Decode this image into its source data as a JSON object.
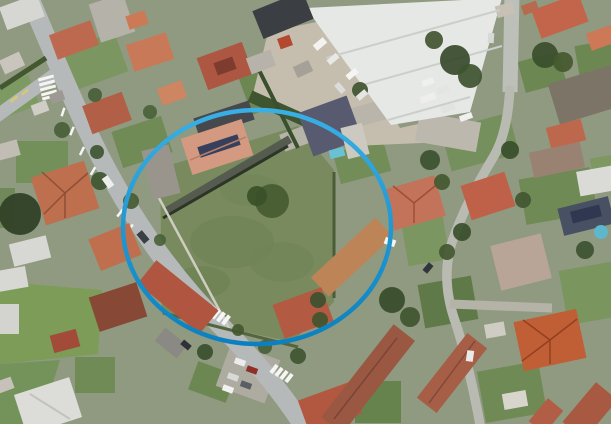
{
  "canvas": {
    "w": 611,
    "h": 424,
    "base": "#8f9a80"
  },
  "annotation": {
    "shape": "ellipse",
    "cx": 257,
    "cy": 227,
    "rx": 134,
    "ry": 117,
    "stroke_w": 4.5,
    "grad_top": "#39b0e5",
    "grad_bottom": "#0b80c0"
  },
  "gardens": [
    [
      272,
      82,
      60,
      48,
      -20,
      "#6d8753"
    ],
    [
      480,
      142,
      70,
      42,
      -15,
      "#75905c"
    ],
    [
      558,
      196,
      72,
      46,
      -10,
      "#6f8a55"
    ],
    [
      598,
      292,
      70,
      55,
      -10,
      "#7a955e"
    ],
    [
      512,
      392,
      62,
      52,
      -10,
      "#6f8a55"
    ],
    [
      378,
      402,
      46,
      42,
      0,
      "#66824d"
    ],
    [
      92,
      62,
      62,
      42,
      -20,
      "#7b9660"
    ],
    [
      14,
      97,
      42,
      32,
      -20,
      "#7e9a63"
    ],
    [
      142,
      142,
      52,
      38,
      -18,
      "#708b56"
    ],
    [
      600,
      62,
      45,
      40,
      -10,
      "#6d8753"
    ],
    [
      448,
      302,
      54,
      44,
      -10,
      "#5f7a48"
    ],
    [
      42,
      162,
      52,
      42,
      0,
      "#74905a"
    ],
    [
      8,
      392,
      32,
      32,
      0,
      "#75905c"
    ],
    [
      542,
      72,
      42,
      32,
      -15,
      "#6d8753"
    ],
    [
      362,
      162,
      52,
      32,
      -15,
      "#728d58"
    ],
    [
      424,
      232,
      42,
      62,
      -10,
      "#7b9660"
    ],
    [
      612,
      170,
      40,
      30,
      -10,
      "#7d9861"
    ],
    [
      212,
      382,
      40,
      30,
      20,
      "#6d8753"
    ],
    [
      95,
      375,
      40,
      36,
      0,
      "#708b56"
    ],
    [
      0,
      208,
      30,
      40,
      0,
      "#70895a"
    ]
  ],
  "fields": [
    {
      "pts": [
        [
          0,
          282
        ],
        [
          102,
          290
        ],
        [
          98,
          354
        ],
        [
          0,
          364
        ]
      ],
      "fill": "#7c9c58"
    },
    {
      "pts": [
        [
          0,
          364
        ],
        [
          60,
          360
        ],
        [
          40,
          424
        ],
        [
          0,
          424
        ]
      ],
      "fill": "#74935a"
    }
  ],
  "lawn": {
    "pts": [
      [
        160,
        168
      ],
      [
        298,
        126
      ],
      [
        334,
        170
      ],
      [
        334,
        302
      ],
      [
        292,
        342
      ],
      [
        162,
        314
      ]
    ],
    "fill": "#798b5e"
  },
  "lawn_spots": [
    [
      232,
      242,
      42,
      26,
      "#6e8253"
    ],
    [
      282,
      262,
      32,
      20,
      "#708457"
    ],
    [
      202,
      282,
      28,
      16,
      "#6c8051"
    ],
    [
      250,
      190,
      30,
      16,
      "#70855a"
    ]
  ],
  "yard": {
    "pts": [
      [
        268,
        32
      ],
      [
        336,
        18
      ],
      [
        400,
        128
      ],
      [
        436,
        120
      ],
      [
        444,
        142
      ],
      [
        352,
        146
      ],
      [
        252,
        98
      ]
    ],
    "fill": "#c5beae"
  },
  "warehouse": {
    "pts": [
      [
        306,
        8
      ],
      [
        502,
        -2
      ],
      [
        470,
        112
      ],
      [
        391,
        125
      ]
    ],
    "fill": "#e6e8e5"
  },
  "paved": [
    [
      448,
      132,
      62,
      30,
      10,
      "#bcb8ad"
    ],
    [
      302,
      136,
      42,
      18,
      -20,
      "#b6b3a8"
    ],
    [
      360,
      116,
      52,
      20,
      -15,
      "#b9b5aa"
    ],
    [
      248,
      373,
      52,
      46,
      20,
      "#aeaba1"
    ],
    [
      112,
      18,
      36,
      40,
      -18,
      "#b5b2a9"
    ]
  ],
  "roads": [
    {
      "d": "M 28,-6 C 60,70 85,130 110,175 C 140,230 175,280 225,330 C 255,360 285,396 306,430",
      "w": 19,
      "c": "#b6b9ba",
      "n": "main-road"
    },
    {
      "d": "M -6,118 L 58,72",
      "w": 13,
      "c": "#b6b9ba",
      "n": "side-street"
    },
    {
      "d": "M 512,-6 L 510,92",
      "w": 15,
      "c": "#bdbfb9",
      "n": "right-street"
    },
    {
      "d": "M 510,86 Q 508,132 494,156 Q 466,202 452,242 Q 440,280 456,324 Q 469,364 481,430",
      "w": 9.5,
      "c": "#b9bbb3",
      "n": "right-lane"
    },
    {
      "d": "M 450,304 L 552,308",
      "w": 9,
      "c": "#b5b2a8",
      "n": "driveway-lane"
    }
  ],
  "ground_lines": [
    [
      250,
      96,
      362,
      146,
      "#3f5530",
      12
    ],
    [
      165,
      212,
      290,
      139,
      "#565b50",
      8
    ],
    [
      163,
      218,
      288,
      146,
      "#2c3526",
      3
    ],
    [
      152,
      185,
      230,
      330,
      "#cfcdc2",
      2.5
    ],
    [
      163,
      313,
      298,
      347,
      "#55663f",
      3
    ],
    [
      334,
      172,
      334,
      298,
      "#4a5c38",
      3
    ],
    [
      0,
      88,
      46,
      58,
      "#44582f",
      5
    ],
    [
      255,
      62,
      298,
      148,
      "#3a4f2c",
      4
    ]
  ],
  "markings": [
    [
      46,
      78,
      16,
      3,
      -15,
      "#f5f5f3"
    ],
    [
      47,
      83,
      16,
      3,
      -15,
      "#f5f5f3"
    ],
    [
      48,
      88,
      16,
      3,
      -15,
      "#f5f5f3"
    ],
    [
      49,
      93,
      16,
      3,
      -15,
      "#f5f5f3"
    ],
    [
      50,
      97,
      16,
      3,
      -15,
      "#f5f5f3"
    ],
    [
      14,
      99,
      9,
      2.5,
      -38,
      "#d8c96d"
    ],
    [
      25,
      92,
      8,
      2.5,
      -38,
      "#d8c96d"
    ],
    [
      63,
      112,
      2.5,
      9,
      18,
      "#f5f5f3"
    ],
    [
      72,
      131,
      2.5,
      9,
      22,
      "#f5f5f3"
    ],
    [
      82,
      151,
      2.5,
      9,
      26,
      "#f5f5f3"
    ],
    [
      93,
      171,
      2.5,
      9,
      30,
      "#f5f5f3"
    ],
    [
      120,
      213,
      2.5,
      9,
      38,
      "#f5f5f3"
    ],
    [
      130,
      228,
      2.5,
      9,
      40,
      "#f5f5f3"
    ],
    [
      206,
      308,
      4,
      11,
      38,
      "#f5f5f3"
    ],
    [
      211,
      311,
      4,
      11,
      38,
      "#f5f5f3"
    ],
    [
      216,
      314,
      4,
      11,
      38,
      "#f5f5f3"
    ],
    [
      221,
      317,
      4,
      11,
      38,
      "#f5f5f3"
    ],
    [
      226,
      320,
      4,
      11,
      38,
      "#f5f5f3"
    ],
    [
      274,
      369,
      4,
      10,
      38,
      "#f5f5f3"
    ],
    [
      279,
      372,
      4,
      10,
      38,
      "#f5f5f3"
    ],
    [
      284,
      375,
      4,
      10,
      38,
      "#f5f5f3"
    ],
    [
      289,
      378,
      4,
      10,
      38,
      "#f5f5f3"
    ]
  ],
  "buildings": [
    [
      22,
      12,
      40,
      24,
      -20,
      "#d6d6d2"
    ],
    [
      74,
      40,
      44,
      26,
      -20,
      "#bd6950"
    ],
    [
      150,
      52,
      42,
      28,
      -18,
      "#c87a58"
    ],
    [
      107,
      113,
      42,
      30,
      -20,
      "#b25f47"
    ],
    [
      172,
      93,
      26,
      18,
      -20,
      "#cd8562"
    ],
    [
      12,
      63,
      22,
      15,
      -25,
      "#c9c5bc"
    ],
    [
      57,
      97,
      14,
      10,
      -20,
      "#9c9a92"
    ],
    [
      137,
      20,
      20,
      14,
      -18,
      "#cc7a55"
    ],
    [
      8,
      150,
      22,
      16,
      -15,
      "#c2bdb4"
    ],
    [
      40,
      108,
      16,
      11,
      -20,
      "#d0cdc6"
    ],
    [
      283,
      15,
      54,
      30,
      -22,
      "#3b3f44"
    ],
    [
      225,
      66,
      48,
      34,
      -20,
      "#ad5742"
    ],
    [
      285,
      42,
      13,
      11,
      -20,
      "#b34930"
    ],
    [
      261,
      62,
      26,
      17,
      -20,
      "#b7b3aa"
    ],
    [
      303,
      69,
      17,
      12,
      -25,
      "#a5a199"
    ],
    [
      560,
      16,
      50,
      30,
      -20,
      "#c2654a"
    ],
    [
      601,
      38,
      26,
      18,
      -20,
      "#cd7856"
    ],
    [
      585,
      95,
      65,
      42,
      -17,
      "#7b7467"
    ],
    [
      505,
      10,
      18,
      12,
      -15,
      "#c6c0b5"
    ],
    [
      530,
      8,
      16,
      10,
      -20,
      "#b86a4e"
    ],
    [
      566,
      134,
      36,
      22,
      -15,
      "#bd684c"
    ],
    [
      557,
      160,
      52,
      26,
      -12,
      "#9a8273"
    ],
    [
      596,
      181,
      36,
      25,
      -10,
      "#dadad6"
    ],
    [
      586,
      216,
      52,
      28,
      -14,
      "#485064"
    ],
    [
      488,
      196,
      46,
      36,
      -18,
      "#bf6048"
    ],
    [
      414,
      203,
      54,
      42,
      -16,
      "#c3735a"
    ],
    [
      521,
      262,
      52,
      46,
      -14,
      "#b8a598"
    ],
    [
      224,
      119,
      58,
      20,
      -18,
      "#45494e"
    ],
    [
      217,
      147,
      64,
      38,
      -18,
      "#d39a81"
    ],
    [
      161,
      172,
      28,
      50,
      -14,
      "#99958c"
    ],
    [
      330,
      126,
      52,
      46,
      -20,
      "#585a70"
    ],
    [
      352,
      257,
      88,
      26,
      -43,
      "#bd8457"
    ],
    [
      303,
      313,
      52,
      36,
      -20,
      "#b25a42"
    ],
    [
      115,
      247,
      44,
      34,
      -22,
      "#c06f4e"
    ],
    [
      178,
      297,
      80,
      30,
      39,
      "#b05640"
    ],
    [
      118,
      307,
      50,
      36,
      -18,
      "#884836"
    ],
    [
      171,
      343,
      28,
      17,
      39,
      "#8a8984"
    ],
    [
      65,
      193,
      56,
      50,
      -18,
      "#bd6f4e"
    ],
    [
      30,
      251,
      38,
      23,
      -14,
      "#d7d7d3"
    ],
    [
      12,
      279,
      30,
      21,
      -10,
      "#d7d7d3"
    ],
    [
      65,
      341,
      27,
      18,
      -15,
      "#a34b39"
    ],
    [
      8,
      319,
      22,
      30,
      0,
      "#d3d3cf"
    ],
    [
      48,
      406,
      58,
      42,
      -18,
      "#dcdcd8"
    ],
    [
      5,
      385,
      16,
      12,
      -20,
      "#c7c2b9"
    ],
    [
      330,
      407,
      56,
      34,
      -20,
      "#b25841"
    ],
    [
      368,
      379,
      118,
      27,
      -52,
      "#9a5843"
    ],
    [
      452,
      373,
      82,
      25,
      -52,
      "#a65e46"
    ],
    [
      550,
      340,
      64,
      50,
      -12,
      "#c05e36"
    ],
    [
      590,
      411,
      52,
      28,
      -50,
      "#a85942"
    ],
    [
      546,
      416,
      30,
      20,
      -50,
      "#b25e47"
    ],
    [
      515,
      400,
      24,
      16,
      -10,
      "#d8d5cd"
    ],
    [
      495,
      330,
      20,
      14,
      -10,
      "#cfccc3"
    ]
  ],
  "details_rects": [
    [
      225,
      66,
      20,
      13,
      -20,
      "#7e3c2e"
    ],
    [
      219,
      146,
      42,
      11,
      -18,
      "#36405c"
    ],
    [
      337,
      153,
      15,
      9,
      -14,
      "#68c2d4"
    ],
    [
      586,
      214,
      30,
      12,
      -14,
      "#2f3850"
    ],
    [
      355,
      141,
      22,
      32,
      -14,
      "#ccc9c0"
    ]
  ],
  "details_lines": [
    [
      326,
      58,
      500,
      10,
      "#cbcfcc",
      2
    ],
    [
      352,
      88,
      502,
      46,
      "#cbcfcc",
      2
    ],
    [
      388,
      120,
      470,
      97,
      "#cbcfcc",
      2
    ],
    [
      42,
      172,
      65,
      193,
      "#8f4f35",
      1.5
    ],
    [
      88,
      173,
      65,
      193,
      "#8f4f35",
      1.5
    ],
    [
      65,
      218,
      65,
      193,
      "#8f4f35",
      1.5
    ],
    [
      44,
      214,
      65,
      193,
      "#8f4f35",
      1.5
    ],
    [
      523,
      320,
      550,
      340,
      "#93401f",
      1.5
    ],
    [
      577,
      319,
      550,
      340,
      "#93401f",
      1.5
    ],
    [
      550,
      364,
      550,
      340,
      "#93401f",
      1.5
    ],
    [
      522,
      361,
      550,
      340,
      "#93401f",
      1.5
    ],
    [
      393,
      186,
      414,
      203,
      "#9c4f3a",
      1.5
    ],
    [
      435,
      186,
      414,
      203,
      "#9c4f3a",
      1.5
    ],
    [
      414,
      223,
      414,
      203,
      "#9c4f3a",
      1.5
    ],
    [
      190,
      160,
      246,
      137,
      "#b98069",
      1.5
    ],
    [
      30,
      394,
      70,
      419,
      "#c2c2be",
      2
    ],
    [
      334,
      419,
      397,
      338,
      "#7a4435",
      1.5
    ],
    [
      429,
      403,
      475,
      341,
      "#84493a",
      1.5
    ]
  ],
  "circles": [
    [
      601,
      232,
      7,
      "#5fb7cc"
    ]
  ],
  "trees": [
    [
      455,
      60,
      15,
      "#37492b"
    ],
    [
      470,
      76,
      12,
      "#3e5230"
    ],
    [
      434,
      40,
      9,
      "#415430"
    ],
    [
      545,
      55,
      13,
      "#3a4e2d"
    ],
    [
      563,
      62,
      10,
      "#44582f"
    ],
    [
      20,
      214,
      21,
      "#2f3f26"
    ],
    [
      100,
      181,
      9,
      "#3f5530"
    ],
    [
      131,
      201,
      8,
      "#475c33"
    ],
    [
      62,
      130,
      8,
      "#48603a"
    ],
    [
      97,
      152,
      7,
      "#3f5530"
    ],
    [
      150,
      112,
      7,
      "#4a6238"
    ],
    [
      430,
      160,
      10,
      "#3c5130"
    ],
    [
      442,
      182,
      8,
      "#44582f"
    ],
    [
      462,
      232,
      9,
      "#3a4e2c"
    ],
    [
      447,
      252,
      8,
      "#435730"
    ],
    [
      392,
      300,
      13,
      "#374b2a"
    ],
    [
      410,
      317,
      10,
      "#415530"
    ],
    [
      298,
      356,
      8,
      "#3f5530"
    ],
    [
      265,
      347,
      7,
      "#47603a"
    ],
    [
      205,
      352,
      8,
      "#3a4f2c"
    ],
    [
      238,
      330,
      6,
      "#44582f"
    ],
    [
      360,
      90,
      8,
      "#3f5530"
    ],
    [
      510,
      150,
      9,
      "#3a4e2c"
    ],
    [
      523,
      200,
      8,
      "#425631"
    ],
    [
      585,
      250,
      9,
      "#3d5230"
    ],
    [
      272,
      201,
      17,
      "#465c31"
    ],
    [
      257,
      196,
      10,
      "#3a5028"
    ],
    [
      160,
      240,
      6,
      "#4a6238"
    ],
    [
      318,
      300,
      8,
      "#3c5130"
    ],
    [
      95,
      95,
      7,
      "#486038"
    ],
    [
      320,
      320,
      8,
      "#41552e"
    ]
  ],
  "vehicles": [
    [
      320,
      44,
      13,
      7,
      -40,
      "#f2f2f0"
    ],
    [
      333,
      59,
      12,
      6,
      -40,
      "#e8e8e6"
    ],
    [
      352,
      74,
      12,
      6,
      -40,
      "#f5f5f3"
    ],
    [
      340,
      88,
      11,
      6,
      50,
      "#dcdcda"
    ],
    [
      362,
      95,
      11,
      6,
      -40,
      "#e5e5e3"
    ],
    [
      428,
      98,
      16,
      7,
      -20,
      "#eeeeec"
    ],
    [
      448,
      108,
      14,
      7,
      -20,
      "#e2e2e0"
    ],
    [
      466,
      117,
      13,
      6,
      -20,
      "#f0f0ee"
    ],
    [
      490,
      25,
      6,
      11,
      4,
      "#e8e8e6"
    ],
    [
      491,
      38,
      6,
      10,
      4,
      "#d8d8d6"
    ],
    [
      428,
      82,
      12,
      6,
      -20,
      "#f0f0ee"
    ],
    [
      443,
      90,
      12,
      6,
      -20,
      "#e4e4e2"
    ],
    [
      108,
      182,
      12,
      7,
      55,
      "#ededeb"
    ],
    [
      143,
      237,
      12,
      7,
      50,
      "#3a3f46"
    ],
    [
      240,
      362,
      11,
      6,
      20,
      "#ececea"
    ],
    [
      252,
      370,
      11,
      6,
      20,
      "#8f2f26"
    ],
    [
      233,
      377,
      11,
      6,
      20,
      "#d9d9d7"
    ],
    [
      228,
      389,
      11,
      6,
      20,
      "#f1f1ef"
    ],
    [
      246,
      385,
      11,
      6,
      20,
      "#5a5f66"
    ],
    [
      390,
      242,
      11,
      7,
      20,
      "#f4f4f2"
    ],
    [
      186,
      345,
      10,
      6,
      40,
      "#2e3238"
    ],
    [
      470,
      356,
      7,
      11,
      8,
      "#e9e9e7"
    ],
    [
      428,
      268,
      10,
      6,
      -50,
      "#31353c"
    ]
  ]
}
